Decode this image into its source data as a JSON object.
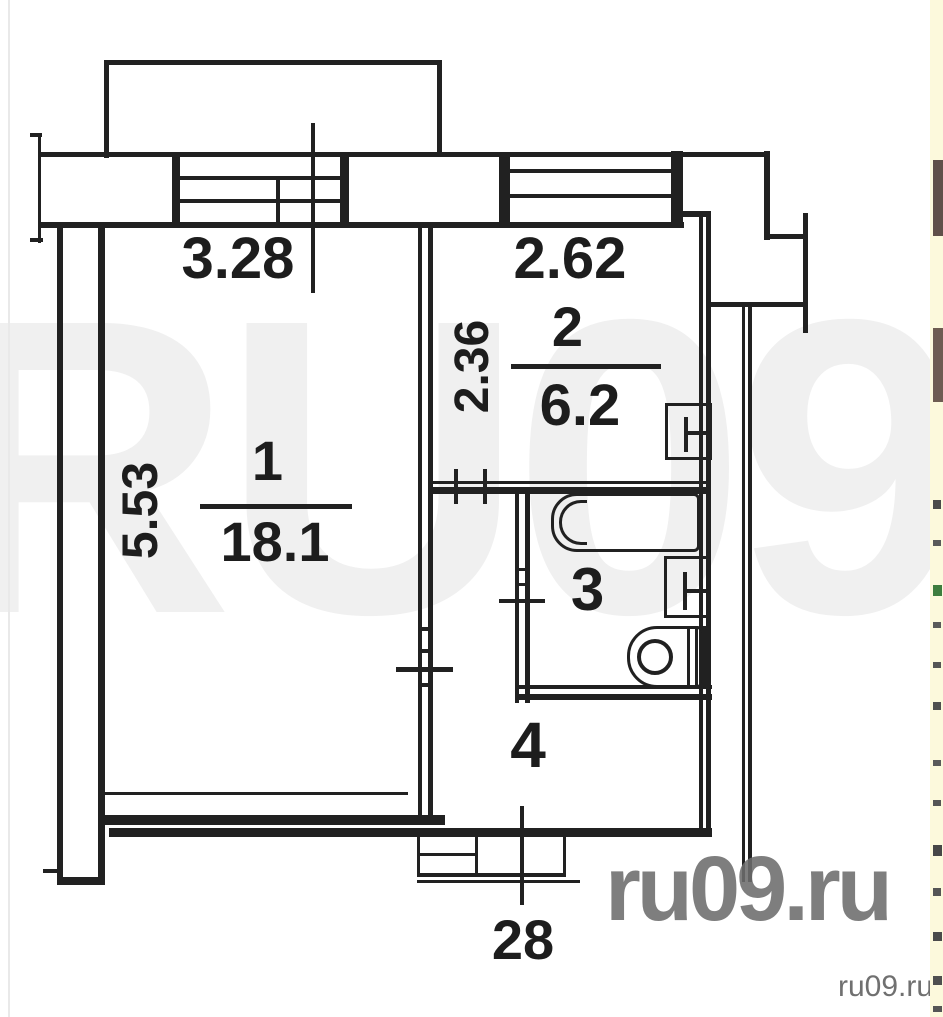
{
  "floorplan": {
    "rooms": {
      "room1": {
        "number": "1",
        "area": "18.1"
      },
      "room2": {
        "number": "2",
        "area": "6.2"
      },
      "room3": {
        "number": "3"
      },
      "room4": {
        "number": "4"
      }
    },
    "dimensions": {
      "room1_width": "3.28",
      "room1_depth": "5.53",
      "kitchen_width": "2.62",
      "kitchen_depth": "2.36",
      "entry_width": "28"
    }
  },
  "watermarks": {
    "giant_text": "RU09",
    "large_text": "ru09.ru",
    "corner_text": "ru09.ru",
    "giant_color": "#f0f0f0",
    "large_color": "#6d6d6d",
    "corner_color": "#707070"
  },
  "colors": {
    "line": "#212121",
    "side_strip_bg": "#fcf9dc"
  }
}
